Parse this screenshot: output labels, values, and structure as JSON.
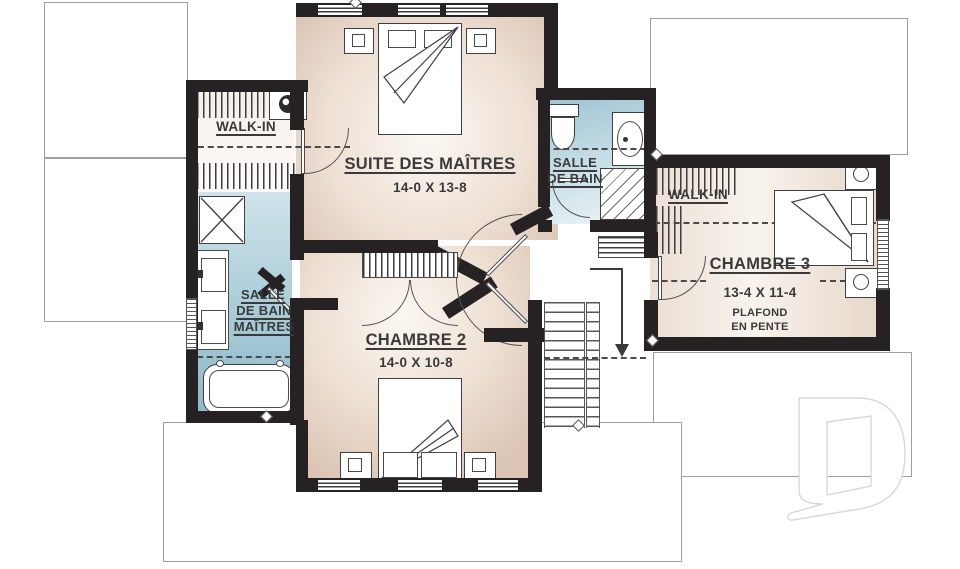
{
  "rooms": {
    "master_suite": {
      "name": "SUITE DES MAÎTRES",
      "dims": "14-0 X 13-8"
    },
    "master_walkin": {
      "name": "WALK-IN"
    },
    "bathroom": {
      "line1": "SALLE",
      "line2": "DE BAIN"
    },
    "master_bathroom": {
      "line1": "SALLE",
      "line2": "DE BAIN",
      "line3": "MAÎTRES"
    },
    "bedroom2": {
      "name": "CHAMBRE 2",
      "dims": "14-0 X 10-8"
    },
    "bedroom3": {
      "name": "CHAMBRE 3",
      "dims": "13-4 X 11-4",
      "note1": "PLAFOND",
      "note2": "EN PENTE"
    },
    "bedroom3_walkin": {
      "name": "WALK-IN"
    }
  },
  "icons": {
    "ceiling_fan": "●",
    "lamp_round": "○",
    "lamp_square": "▢",
    "stairs_down_arrow": "↓",
    "brand_logo": "D"
  },
  "colors": {
    "wall": "#262223",
    "bedroom_floor": "#dcc5b4",
    "bedroom_floor_light": "#fbf7f2",
    "bathroom_floor": "#8db9c9",
    "bathroom_floor_light": "#eef5f7",
    "label_text": "#3a3a3a",
    "roof_outline": "#9e9e9e",
    "logo_outline": "#d8d8d8"
  }
}
